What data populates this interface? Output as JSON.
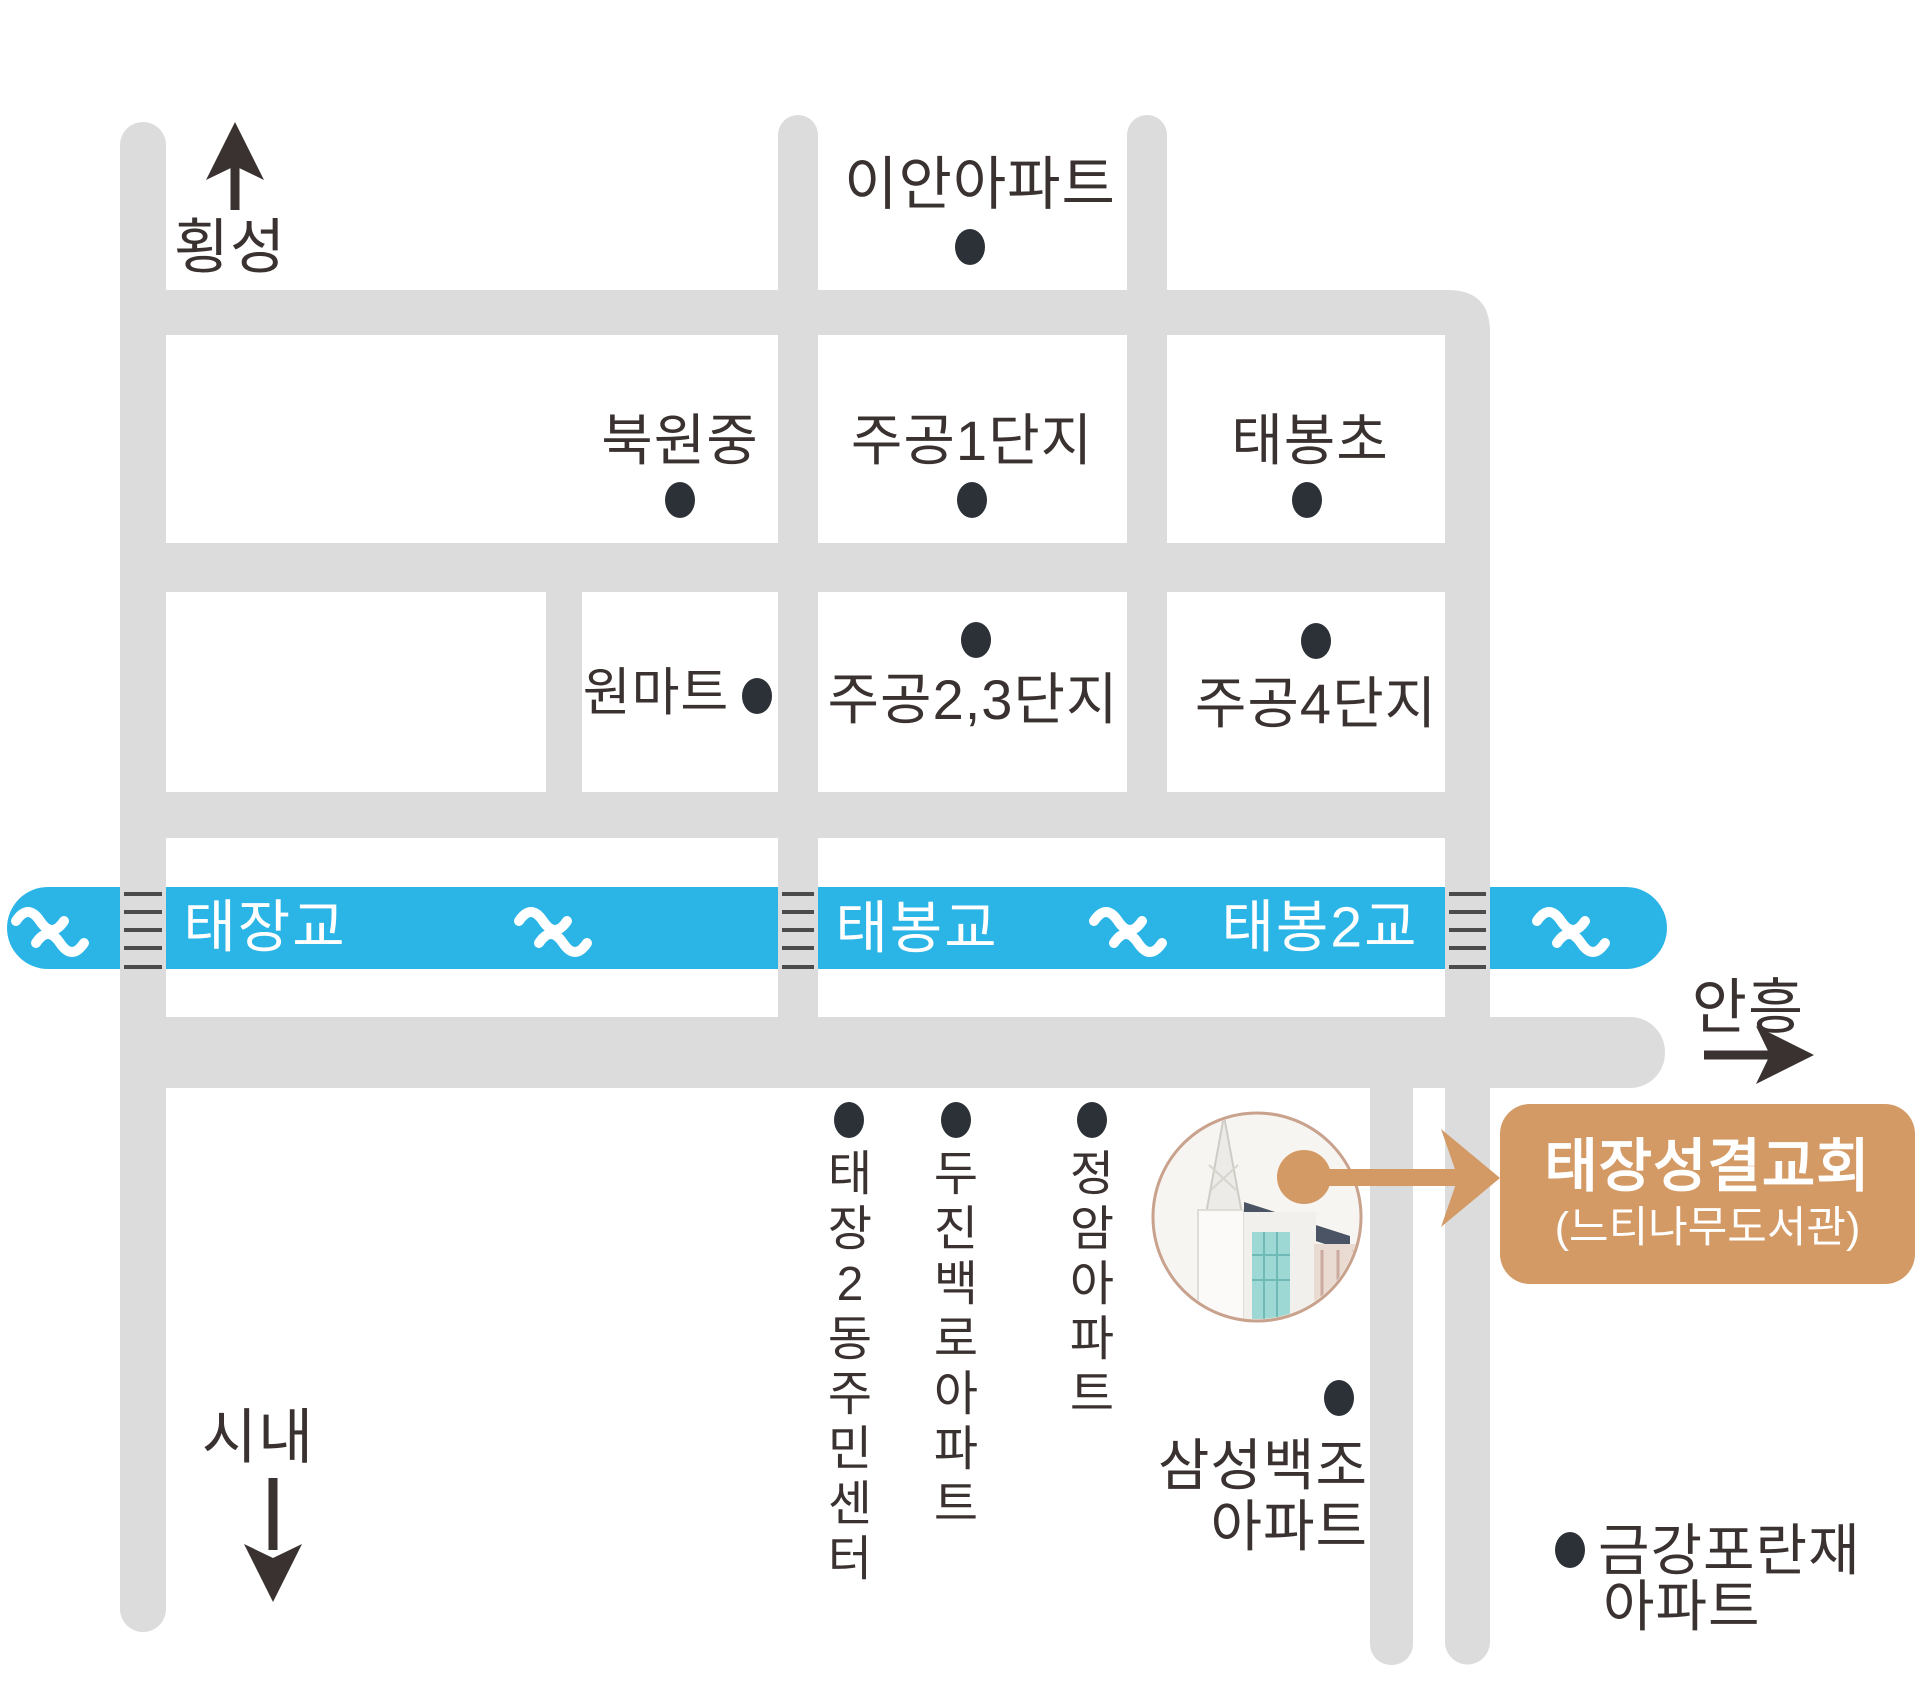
{
  "colors": {
    "road": "#dcdcdc",
    "river": "#2bb5e6",
    "accent": "#d49a66",
    "dot": "#2b3137",
    "text": "#3a3230",
    "bridge-hatch": "#4b4b4b"
  },
  "directions": {
    "north": "횡성",
    "south": "시내",
    "east": "안흥"
  },
  "landmarks": {
    "ian_apt": "이안아파트",
    "bukwon_middle_school": "북원중",
    "jugong_1danji": "주공1단지",
    "taebong_elementary": "태봉초",
    "won_mart": "원마트",
    "jugong_23danji": "주공2,3단지",
    "jugong_4danji": "주공4단지",
    "taejang2dong_center": "태장2동주민센터",
    "dujin_baekro_apt": "두진백로아파트",
    "jeongam_apt": "정암아파트",
    "samsung_baekjo_line1": "삼성백조",
    "samsung_baekjo_line2": "아파트",
    "geumgang_poranjae_line1": "금강포란재",
    "geumgang_poranjae_line2": "아파트"
  },
  "bridges": {
    "taejang_bridge": "태장교",
    "taebong_bridge": "태봉교",
    "taebong2_bridge": "태봉2교"
  },
  "destination": {
    "name": "태장성결교회",
    "subtitle": "(느티나무도서관)"
  }
}
